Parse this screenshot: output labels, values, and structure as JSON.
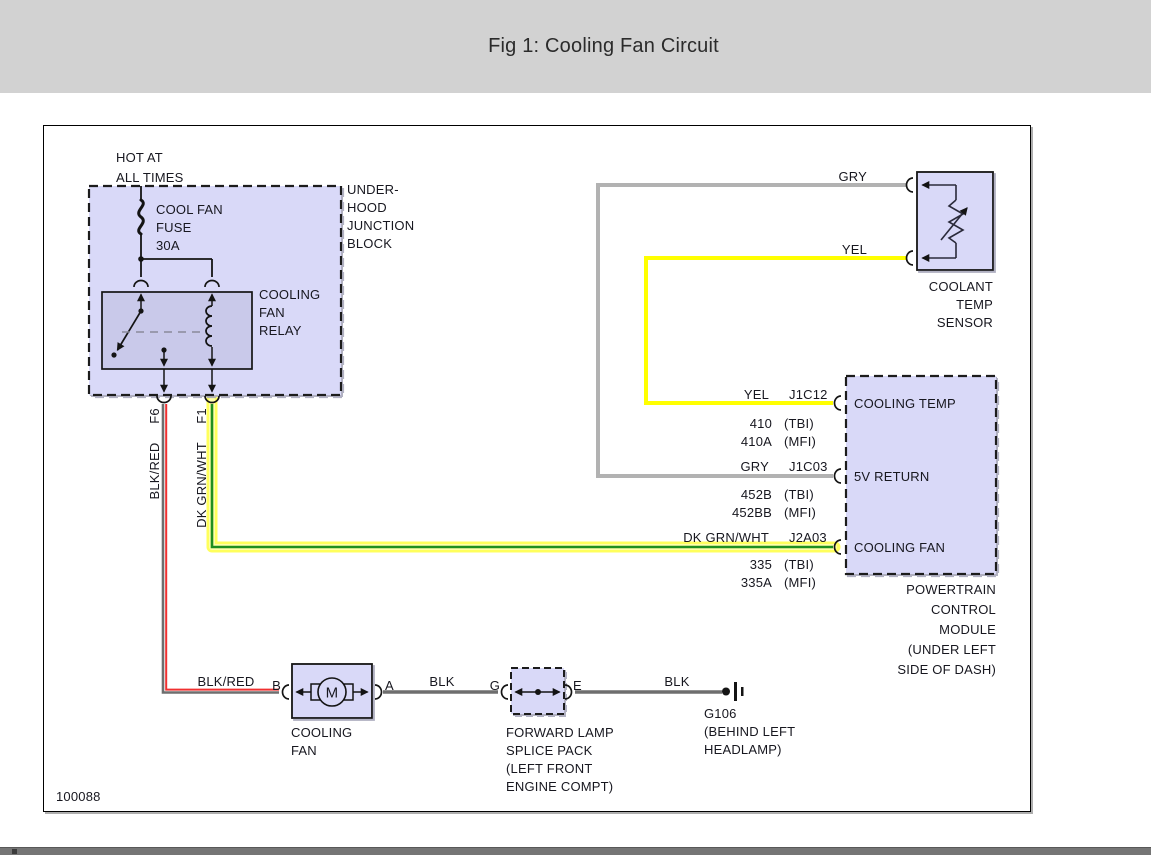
{
  "header": {
    "title": "Fig 1: Cooling Fan Circuit"
  },
  "footer_id": "100088",
  "power_source": {
    "line1": "HOT AT",
    "line2": "ALL TIMES"
  },
  "junction_block": {
    "caption": [
      "UNDER-",
      "HOOD",
      "JUNCTION",
      "BLOCK"
    ]
  },
  "fuse": {
    "caption": [
      "COOL FAN",
      "FUSE",
      "30A"
    ]
  },
  "relay": {
    "caption": [
      "COOLING",
      "FAN",
      "RELAY"
    ]
  },
  "wires": {
    "blk_red": {
      "pin": "F6",
      "color_label": "BLK/RED"
    },
    "dk_grn_wht": {
      "pin": "F1",
      "color_label": "DK GRN/WHT"
    },
    "blk_red_motor": {
      "color_label": "BLK/RED"
    },
    "blk_motor_splice": {
      "color_label": "BLK"
    },
    "blk_splice_ground": {
      "color_label": "BLK"
    }
  },
  "sensor": {
    "gry_label": "GRY",
    "yel_label": "YEL",
    "caption": [
      "COOLANT",
      "TEMP",
      "SENSOR"
    ]
  },
  "pcm": {
    "pins": [
      {
        "wire": "YEL",
        "connector": "J1C12",
        "name": "COOLING TEMP",
        "circuits": [
          {
            "num": "410",
            "sys": "(TBI)"
          },
          {
            "num": "410A",
            "sys": "(MFI)"
          }
        ]
      },
      {
        "wire": "GRY",
        "connector": "J1C03",
        "name": "5V RETURN",
        "circuits": [
          {
            "num": "452B",
            "sys": "(TBI)"
          },
          {
            "num": "452BB",
            "sys": "(MFI)"
          }
        ]
      },
      {
        "wire": "DK GRN/WHT",
        "connector": "J2A03",
        "name": "COOLING FAN",
        "circuits": [
          {
            "num": "335",
            "sys": "(TBI)"
          },
          {
            "num": "335A",
            "sys": "(MFI)"
          }
        ]
      }
    ],
    "caption": [
      "POWERTRAIN",
      "CONTROL",
      "MODULE",
      "(UNDER LEFT",
      "SIDE OF DASH)"
    ]
  },
  "motor": {
    "letter": "M",
    "pin_left": "B",
    "pin_right": "A",
    "caption": [
      "COOLING",
      "FAN"
    ]
  },
  "splice": {
    "pin_left": "G",
    "pin_right": "E",
    "caption": [
      "FORWARD LAMP",
      "SPLICE PACK",
      "(LEFT FRONT",
      "ENGINE COMPT)"
    ]
  },
  "ground": {
    "id": "G106",
    "caption": [
      "(BEHIND LEFT",
      "HEADLAMP)"
    ]
  },
  "colors": {
    "box_fill": "#d9d9f8",
    "relay_fill": "#c9c9ea",
    "yellow_wire": "#ffff00",
    "highlight": "#ffff5c",
    "green_wire": "#1f8f1f",
    "red_wire": "#f03030",
    "gray_wire": "#b2b2b2",
    "black_wire": "#6e6e6e",
    "header_bg": "#d2d2d2"
  }
}
